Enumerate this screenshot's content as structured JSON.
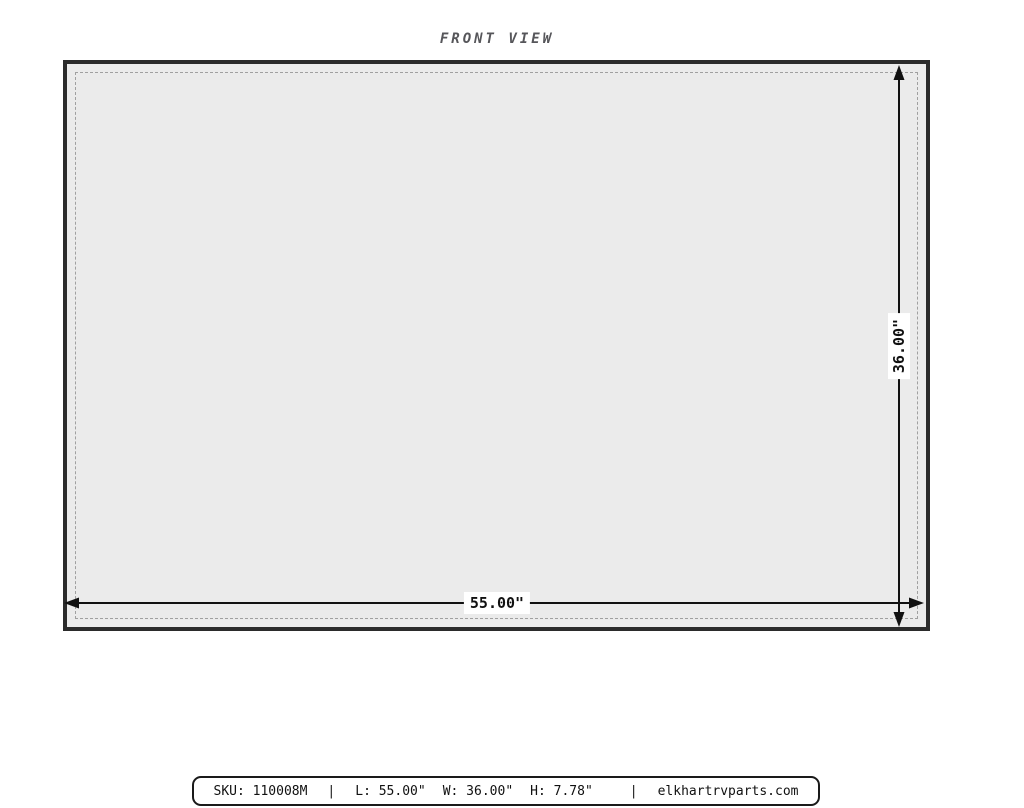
{
  "title": "FRONT VIEW",
  "panel": {
    "description": "front face of part, gray fill with dashed inner outline"
  },
  "dimensions": {
    "width_label": "55.00\"",
    "height_label": "36.00\""
  },
  "footer": {
    "sku": "SKU: 110008M",
    "separator": "|",
    "length": "L: 55.00\"",
    "width": "W: 36.00\"",
    "height": "H: 7.78\"",
    "site": "elkhartrvparts.com"
  },
  "colors": {
    "panel_fill": "#ebebeb",
    "panel_outline": "#2b2b2b",
    "dashed_inner": "#a0a0a0",
    "dimension_line": "#111111",
    "title_text": "#56565a",
    "footer_border": "#1a1a1a",
    "footer_bg": "#ffffff"
  }
}
